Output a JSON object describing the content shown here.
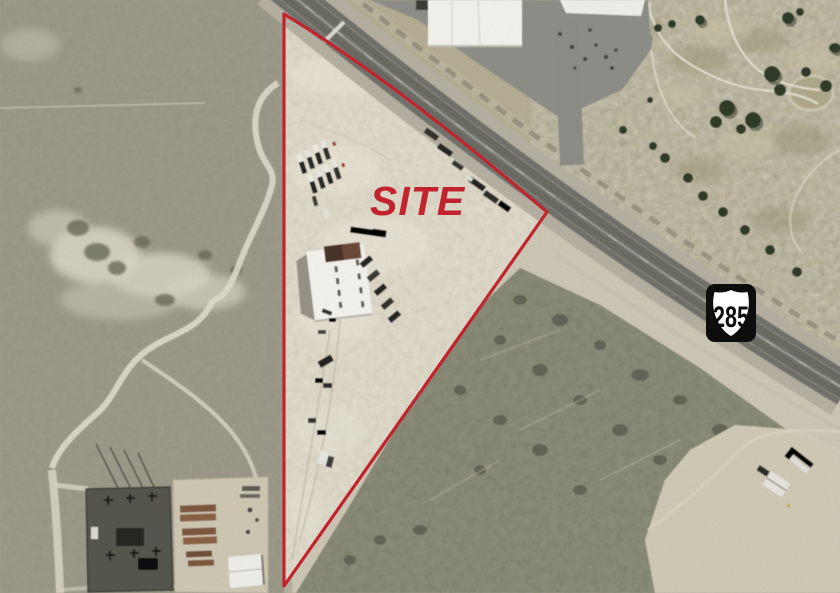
{
  "image": {
    "type": "aerial-site-map",
    "annotations": {
      "site_label": "SITE",
      "annotation_color": "#c2242e",
      "boundary_shape": "triangular parcel outline"
    },
    "highway_shield": {
      "route_number": "285",
      "box_color": "#0d0d0d",
      "shield_color": "#ffffff",
      "number_color": "#0d0d0d"
    },
    "features": {
      "highway": "US Highway 285 running diagonally upper-left to right",
      "site_parcel": "triangular dirt lot with building and parked trucks",
      "truck_rows": "trucks parked in rows at north of site",
      "site_building": "white-roofed building near center of site",
      "substation": "electrical substation and laydown yard, bottom left",
      "golf_course": "turf with trees and cart paths, upper right",
      "scrubland": "dense desert scrub, lower right",
      "homestead": "small white structures, lower right clearing"
    },
    "terrain_colors": {
      "site_dirt": "#d9d3c1",
      "desert_scrub": "#a49f90",
      "dense_scrub": "#7d7d6c",
      "golf_turf": "#b6af94",
      "pavement": "#72726c",
      "shoulder": "#b6b1a2",
      "parking_apron": "#8f8f89"
    }
  }
}
